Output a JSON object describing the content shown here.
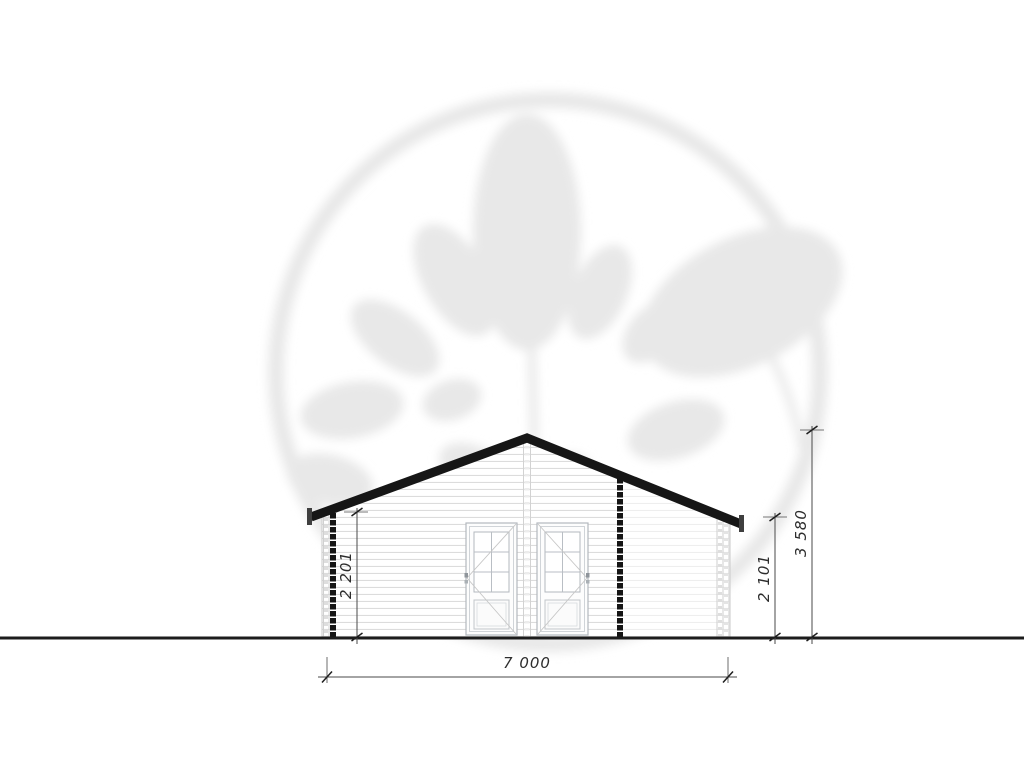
{
  "drawing": {
    "title": "front-elevation",
    "dimensions": {
      "left_wall_height": "2 201",
      "right_eave_height": "2 101",
      "ridge_height": "3 580",
      "total_width": "7 000"
    },
    "colors": {
      "roof": "#161616",
      "ground_line": "#1c1c1c",
      "dimension_lines": "#4a4a4a",
      "siding_lines": "#dcdcdc",
      "door_lines": "#b3b8be",
      "watermark": "#e8e8e8"
    }
  }
}
